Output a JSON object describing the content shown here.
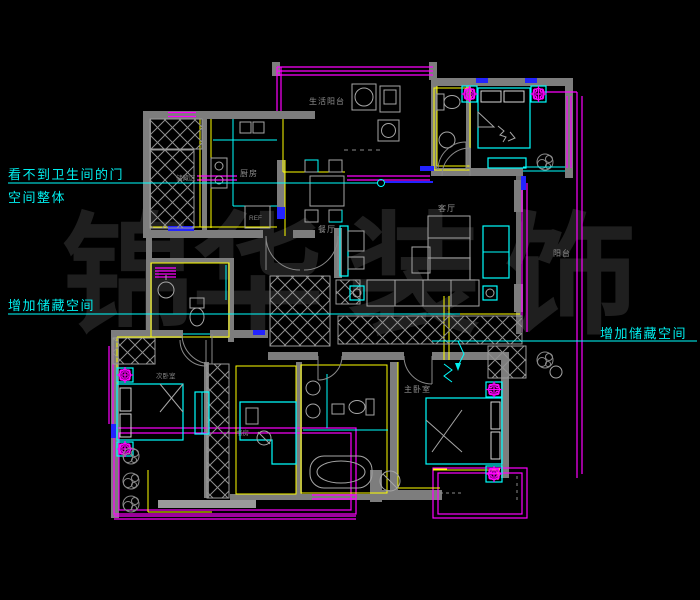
{
  "canvas": {
    "width": 700,
    "height": 600,
    "background": "#000000"
  },
  "watermark": {
    "text": "锦华装饰",
    "chars": [
      "锦",
      "华",
      "装",
      "饰"
    ],
    "color": "#1f1f1f"
  },
  "colors": {
    "wall_gray": "#7d7d7d",
    "furniture_line": "#a6a6a6",
    "fixture_cyan": "#00ffff",
    "window_magenta": "#ff00ff",
    "finish_yellow": "#ffff00",
    "sill_blue": "#2323ff",
    "label_gray": "#8f8f8f",
    "annotation_cyan": "#00efef"
  },
  "annotations": {
    "left_top": {
      "line1": "看不到卫生间的门",
      "line2": "空间整体"
    },
    "left_mid": {
      "text": "增加储藏空间"
    },
    "right_mid": {
      "text": "增加储藏空间"
    }
  },
  "labels": {
    "laundry_balcony": "生活阳台",
    "kitchen": "厨房",
    "storage_area": "储藏区",
    "dining": "餐厅",
    "living": "客厅",
    "balcony_right": "阳台",
    "bedroom_second": "次卧室",
    "study": "书房",
    "master_bedroom": "主卧室",
    "fridge": "REF"
  }
}
